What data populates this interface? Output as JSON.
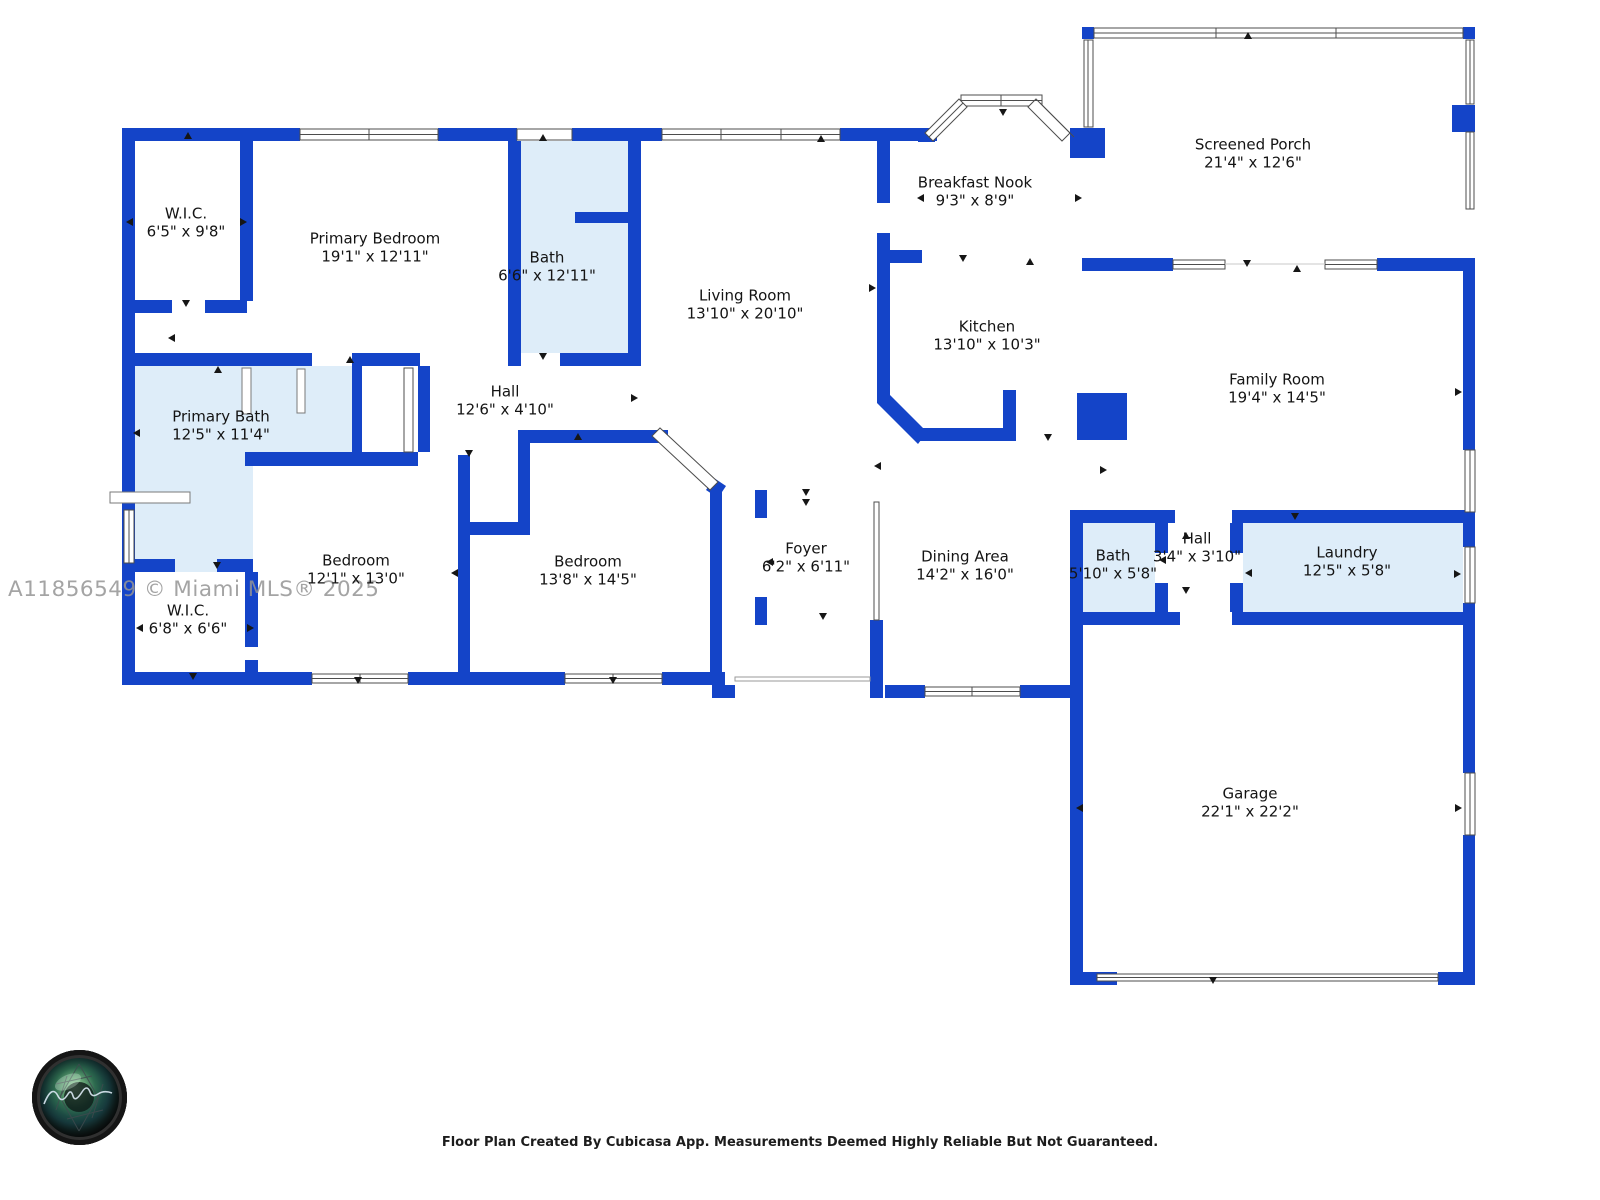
{
  "watermark": "A11856549 © Miami MLS® 2025",
  "caption": "Floor Plan Created By Cubicasa App. Measurements Deemed Highly Reliable But Not Guaranteed.",
  "colors": {
    "wall_blue": "#1444C8",
    "room_light_blue": "#DEEDF9",
    "label_text": "#141414",
    "watermark_gray": "#949494"
  },
  "rooms": [
    {
      "name": "W.I.C.",
      "dims": "6'5\" x 9'8\""
    },
    {
      "name": "Primary Bedroom",
      "dims": "19'1\" x 12'11\""
    },
    {
      "name": "Bath",
      "dims": "6'6\" x 12'11\""
    },
    {
      "name": "Living Room",
      "dims": "13'10\" x 20'10\""
    },
    {
      "name": "Breakfast Nook",
      "dims": "9'3\" x 8'9\""
    },
    {
      "name": "Screened Porch",
      "dims": "21'4\" x 12'6\""
    },
    {
      "name": "Kitchen",
      "dims": "13'10\" x 10'3\""
    },
    {
      "name": "Family Room",
      "dims": "19'4\" x 14'5\""
    },
    {
      "name": "Hall",
      "dims": "12'6\" x 4'10\""
    },
    {
      "name": "Primary Bath",
      "dims": "12'5\" x 11'4\""
    },
    {
      "name": "Bedroom",
      "dims": "12'1\" x 13'0\""
    },
    {
      "name": "Bedroom",
      "dims": "13'8\" x 14'5\""
    },
    {
      "name": "Foyer",
      "dims": "6'2\" x 6'11\""
    },
    {
      "name": "Dining Area",
      "dims": "14'2\" x 16'0\""
    },
    {
      "name": "Bath",
      "dims": "5'10\" x 5'8\""
    },
    {
      "name": "Hall",
      "dims": "3'4\" x 3'10\""
    },
    {
      "name": "Laundry",
      "dims": "12'5\" x 5'8\""
    },
    {
      "name": "W.I.C.",
      "dims": "6'8\" x 6'6\""
    },
    {
      "name": "Garage",
      "dims": "22'1\" x 22'2\""
    }
  ],
  "logo_name": "photographer-camera-lens-logo"
}
